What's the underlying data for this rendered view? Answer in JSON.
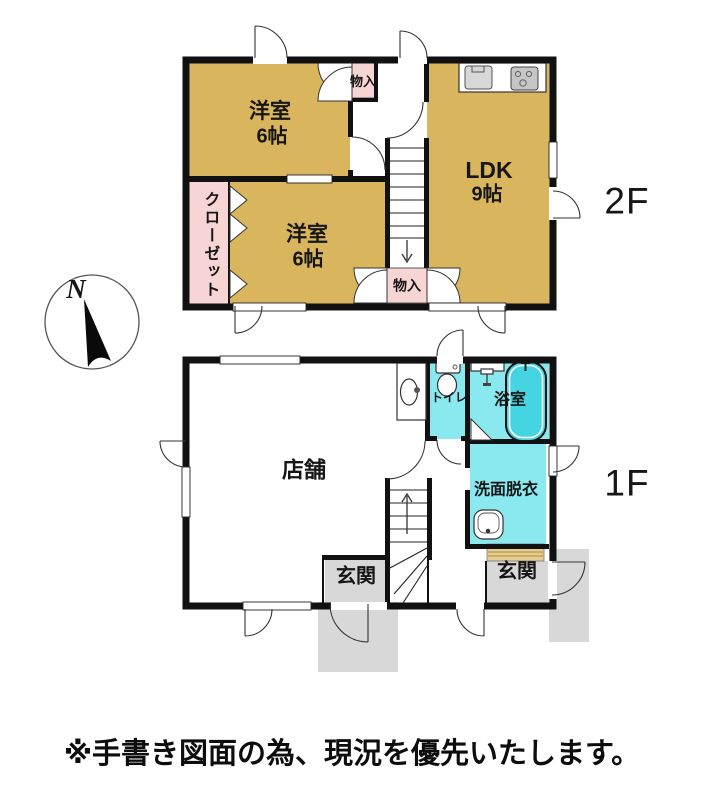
{
  "note": "※手書き図面の為、現況を優先いたします。",
  "compass": {
    "north_label": "N"
  },
  "floor2": {
    "label": "2F",
    "room_yoshitsu_a": {
      "name": "洋室",
      "size": "6帖"
    },
    "room_yoshitsu_b": {
      "name": "洋室",
      "size": "6帖"
    },
    "room_ldk": {
      "name": "LDK",
      "size": "9帖"
    },
    "closet": {
      "name": "クローゼット"
    },
    "storage_top": {
      "name": "物入"
    },
    "storage_bottom": {
      "name": "物入"
    }
  },
  "floor1": {
    "label": "1F",
    "room_shop": {
      "name": "店舗"
    },
    "room_toilet": {
      "name": "トイレ"
    },
    "room_bath": {
      "name": "浴室"
    },
    "room_washroom": {
      "name": "洗面脱衣"
    },
    "entrance_left": {
      "name": "玄関"
    },
    "entrance_right": {
      "name": "玄関"
    }
  },
  "colors": {
    "room_tan": "#d9b55e",
    "room_pink": "#f8d5d5",
    "room_cyan": "#8ae8ef",
    "tub_cyan": "#45d4e2",
    "entry_gray": "#d8d8d8",
    "step_tan": "#e6cc8f",
    "wall_black": "#111111"
  }
}
